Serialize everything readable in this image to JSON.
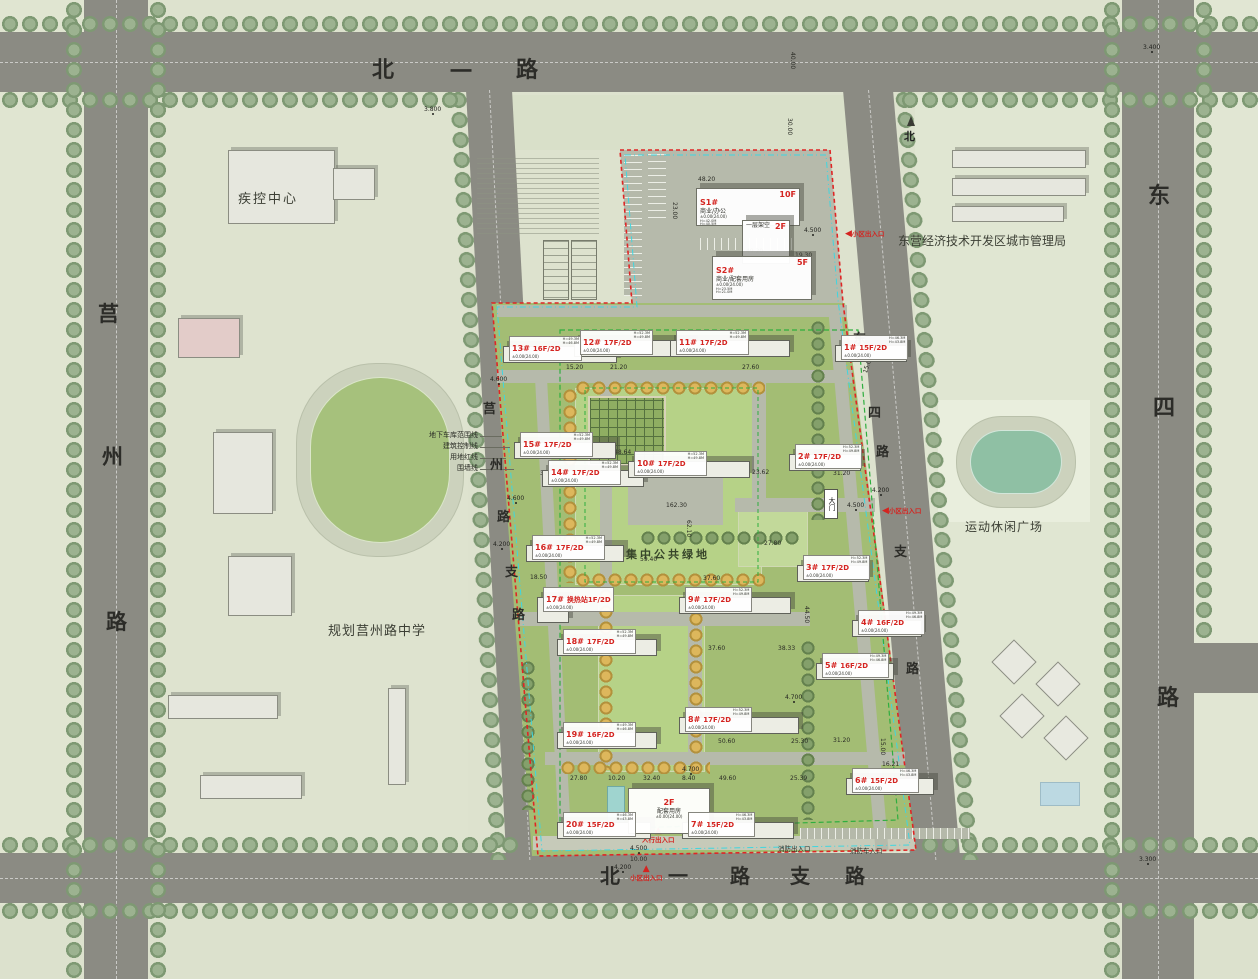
{
  "roads": {
    "north": "北一路",
    "west": "莒州路",
    "west_branch": "莒州路支路",
    "east_branch": "东四路支路",
    "east": "东四路",
    "south_branch": "北一路支路"
  },
  "places": {
    "cdc": "疾控中心",
    "admin_bureau": "东营经济技术开发区城市管理局",
    "school": "规划莒州路中学",
    "sports_plaza": "运动休闲广场",
    "central_green": "集中公共绿地",
    "north_symbol": "北"
  },
  "legend_callouts": [
    "地下车库范围线",
    "建筑控制线",
    "用地红线",
    "围墙线"
  ],
  "building_sub": "±0.00(24.00)",
  "height_notes": {
    "17F/2D": [
      "H=52.3M",
      "H=49.8M"
    ],
    "16F/2D": [
      "H=49.3M",
      "H=46.8M"
    ],
    "15F/2D": [
      "H=46.3M",
      "H=43.8M"
    ]
  },
  "buildings": [
    {
      "label": "13#",
      "floors": "16F/2D",
      "x": 509,
      "y": 336,
      "fw": 112
    },
    {
      "label": "12#",
      "floors": "17F/2D",
      "x": 580,
      "y": 330,
      "fw": 118
    },
    {
      "label": "11#",
      "floors": "17F/2D",
      "x": 676,
      "y": 330,
      "fw": 118
    },
    {
      "label": "1#",
      "floors": "15F/2D",
      "x": 841,
      "y": 335,
      "fw": 70
    },
    {
      "label": "15#",
      "floors": "17F/2D",
      "x": 520,
      "y": 432,
      "fw": 100
    },
    {
      "label": "14#",
      "floors": "17F/2D",
      "x": 548,
      "y": 460,
      "fw": 100
    },
    {
      "label": "10#",
      "floors": "17F/2D",
      "x": 634,
      "y": 451,
      "fw": 120
    },
    {
      "label": "2#",
      "floors": "17F/2D",
      "x": 795,
      "y": 444,
      "fw": 70
    },
    {
      "label": "16#",
      "floors": "17F/2D",
      "x": 532,
      "y": 535,
      "fw": 96
    },
    {
      "label": "3#",
      "floors": "17F/2D",
      "x": 803,
      "y": 555,
      "fw": 70
    },
    {
      "label": "17#",
      "floors": "换热站1F/2D",
      "x": 543,
      "y": 587,
      "fw": 30,
      "fh": 24
    },
    {
      "label": "9#",
      "floors": "17F/2D",
      "x": 685,
      "y": 587,
      "fw": 110
    },
    {
      "label": "4#",
      "floors": "16F/2D",
      "x": 858,
      "y": 610,
      "fw": 68
    },
    {
      "label": "18#",
      "floors": "17F/2D",
      "x": 563,
      "y": 629,
      "fw": 98
    },
    {
      "label": "5#",
      "floors": "16F/2D",
      "x": 822,
      "y": 653,
      "fw": 76
    },
    {
      "label": "19#",
      "floors": "16F/2D",
      "x": 563,
      "y": 722,
      "fw": 98
    },
    {
      "label": "8#",
      "floors": "17F/2D",
      "x": 685,
      "y": 707,
      "fw": 118
    },
    {
      "label": "20#",
      "floors": "15F/2D",
      "x": 563,
      "y": 812,
      "fw": 92
    },
    {
      "label": "7#",
      "floors": "15F/2D",
      "x": 688,
      "y": 812,
      "fw": 110
    },
    {
      "label": "6#",
      "floors": "15F/2D",
      "x": 852,
      "y": 768,
      "fw": 86
    }
  ],
  "commercial": [
    {
      "label": "S1#",
      "floors": "10F",
      "use": "商业/办公",
      "sub": "±0.00(24.00)",
      "h1": "H=42.0M",
      "h2": "H=40.5M",
      "x": 696,
      "y": 188,
      "w": 96,
      "h": 32
    },
    {
      "label": "",
      "floors": "2F",
      "use": "一层架空",
      "sub": "",
      "h1": "",
      "h2": "",
      "x": 742,
      "y": 220,
      "w": 40,
      "h": 38
    },
    {
      "label": "S2#",
      "floors": "5F",
      "use": "商业/配套用房",
      "sub": "±0.00(24.00)",
      "h1": "H=23.5M",
      "h2": "H=21.0M",
      "x": 712,
      "y": 256,
      "w": 92,
      "h": 38
    }
  ],
  "service_building": {
    "floors": "2F",
    "use": "配套用房",
    "sub": "±0.00(24.00)",
    "x": 628,
    "y": 788,
    "w": 74,
    "h": 40
  },
  "entrances": [
    {
      "label": "小区出入口",
      "x": 845,
      "y": 228,
      "k": "arrowL"
    },
    {
      "label": "小区出入口",
      "x": 882,
      "y": 505,
      "k": "arrowL"
    },
    {
      "label": "小区出入口",
      "x": 630,
      "y": 866,
      "k": "tri"
    },
    {
      "label": "人行出入口",
      "x": 642,
      "y": 828,
      "k": "tri"
    },
    {
      "label": "消防出入口",
      "x": 778,
      "y": 843,
      "k": "txt"
    },
    {
      "label": "消防车入口",
      "x": 850,
      "y": 845,
      "k": "txt"
    },
    {
      "label": "大门",
      "x": 824,
      "y": 489,
      "k": "gate"
    }
  ],
  "elevations": [
    {
      "t": "3.800",
      "x": 424,
      "y": 106
    },
    {
      "t": "3.400",
      "x": 1143,
      "y": 44
    },
    {
      "t": "3.300",
      "x": 1139,
      "y": 856
    },
    {
      "t": "4.500",
      "x": 804,
      "y": 227
    },
    {
      "t": "4.200",
      "x": 872,
      "y": 487
    },
    {
      "t": "4.500",
      "x": 847,
      "y": 502
    },
    {
      "t": "4.600",
      "x": 490,
      "y": 376
    },
    {
      "t": "4.600",
      "x": 507,
      "y": 495
    },
    {
      "t": "4.200",
      "x": 493,
      "y": 541
    },
    {
      "t": "4.700",
      "x": 785,
      "y": 694
    },
    {
      "t": "4.700",
      "x": 682,
      "y": 766
    },
    {
      "t": "4.500",
      "x": 630,
      "y": 845
    },
    {
      "t": "4.200",
      "x": 614,
      "y": 864
    }
  ],
  "dimensions": [
    {
      "t": "40.00",
      "x": 796,
      "y": 52,
      "r": 90
    },
    {
      "t": "30.00",
      "x": 793,
      "y": 118,
      "r": 90
    },
    {
      "t": "15.00",
      "x": 862,
      "y": 372,
      "r": -72
    },
    {
      "t": "15.00",
      "x": 886,
      "y": 738,
      "r": 90
    },
    {
      "t": "48.20",
      "x": 698,
      "y": 176
    },
    {
      "t": "23.00",
      "x": 678,
      "y": 202,
      "r": 90
    },
    {
      "t": "49.20",
      "x": 746,
      "y": 248
    },
    {
      "t": "19.30",
      "x": 795,
      "y": 252
    },
    {
      "t": "15.20",
      "x": 566,
      "y": 364
    },
    {
      "t": "21.20",
      "x": 610,
      "y": 364
    },
    {
      "t": "27.60",
      "x": 742,
      "y": 364
    },
    {
      "t": "33.40",
      "x": 540,
      "y": 470
    },
    {
      "t": "48.64",
      "x": 614,
      "y": 449
    },
    {
      "t": "23.62",
      "x": 752,
      "y": 469
    },
    {
      "t": "31.20",
      "x": 833,
      "y": 470
    },
    {
      "t": "162.30",
      "x": 666,
      "y": 502
    },
    {
      "t": "62.10",
      "x": 692,
      "y": 520,
      "r": 90
    },
    {
      "t": "59.40",
      "x": 640,
      "y": 556
    },
    {
      "t": "18.50",
      "x": 530,
      "y": 574
    },
    {
      "t": "37.60",
      "x": 703,
      "y": 575
    },
    {
      "t": "27.80",
      "x": 764,
      "y": 540
    },
    {
      "t": "27.80",
      "x": 570,
      "y": 645
    },
    {
      "t": "41.70",
      "x": 635,
      "y": 644
    },
    {
      "t": "37.60",
      "x": 708,
      "y": 645
    },
    {
      "t": "38.33",
      "x": 778,
      "y": 645
    },
    {
      "t": "44.50",
      "x": 810,
      "y": 606,
      "r": 90
    },
    {
      "t": "27.80",
      "x": 570,
      "y": 737
    },
    {
      "t": "41.70",
      "x": 635,
      "y": 737
    },
    {
      "t": "50.60",
      "x": 718,
      "y": 738
    },
    {
      "t": "25.30",
      "x": 791,
      "y": 738
    },
    {
      "t": "31.20",
      "x": 833,
      "y": 737
    },
    {
      "t": "27.80",
      "x": 570,
      "y": 775
    },
    {
      "t": "10.20",
      "x": 608,
      "y": 775
    },
    {
      "t": "32.40",
      "x": 643,
      "y": 775
    },
    {
      "t": "8.40",
      "x": 682,
      "y": 775
    },
    {
      "t": "49.60",
      "x": 719,
      "y": 775
    },
    {
      "t": "25.39",
      "x": 790,
      "y": 775
    },
    {
      "t": "16.21",
      "x": 882,
      "y": 761
    },
    {
      "t": "10.00",
      "x": 630,
      "y": 856
    }
  ],
  "colors": {
    "accent_red": "#d42420",
    "boundary_red": "#e02525",
    "control_cyan": "#3fd6e0",
    "garage_green": "#2fae3f",
    "road_gray": "#8b8b83",
    "site_green": "#a3bd74",
    "lawn_green": "#b6d287"
  }
}
